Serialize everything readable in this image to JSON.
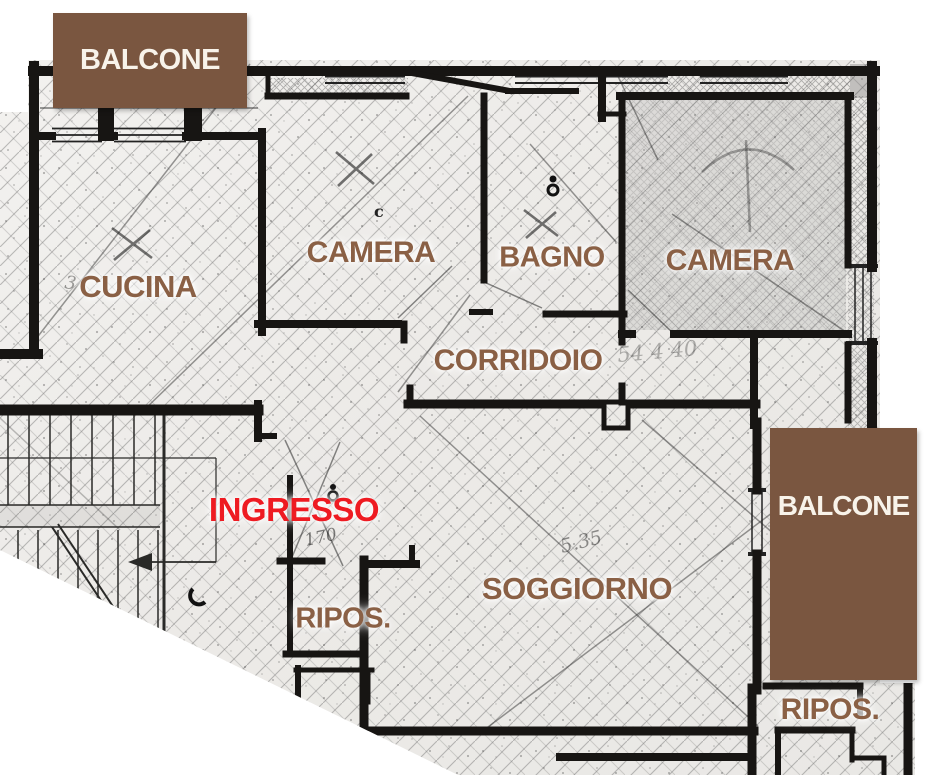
{
  "plan": {
    "balconies": {
      "top": {
        "label": "BALCONE"
      },
      "right": {
        "label": "BALCONE"
      }
    },
    "rooms": {
      "cucina": {
        "label": "CUCINA"
      },
      "camera1": {
        "label": "CAMERA"
      },
      "bagno": {
        "label": "BAGNO"
      },
      "camera2": {
        "label": "CAMERA"
      },
      "corridoio": {
        "label": "CORRIDOIO"
      },
      "ingresso": {
        "label": "INGRESSO"
      },
      "ripostiglio_left": {
        "label": "RIPOS."
      },
      "soggiorno": {
        "label": "SOGGIORNO"
      },
      "ripostiglio_right": {
        "label": "RIPOS."
      }
    },
    "annotations": {
      "soggiorno_dim": "5.35",
      "ingresso_dim": "170",
      "corridoio_dim": "54 4 40",
      "cucina_dim": "3",
      "camera1_mark": "c"
    },
    "colors": {
      "balcony_fill": "#7a5640",
      "balcony_text": "#f8f3ea",
      "room_label": "#8a6045",
      "entrance_label": "#ee1b22",
      "wall": "#171513"
    }
  }
}
